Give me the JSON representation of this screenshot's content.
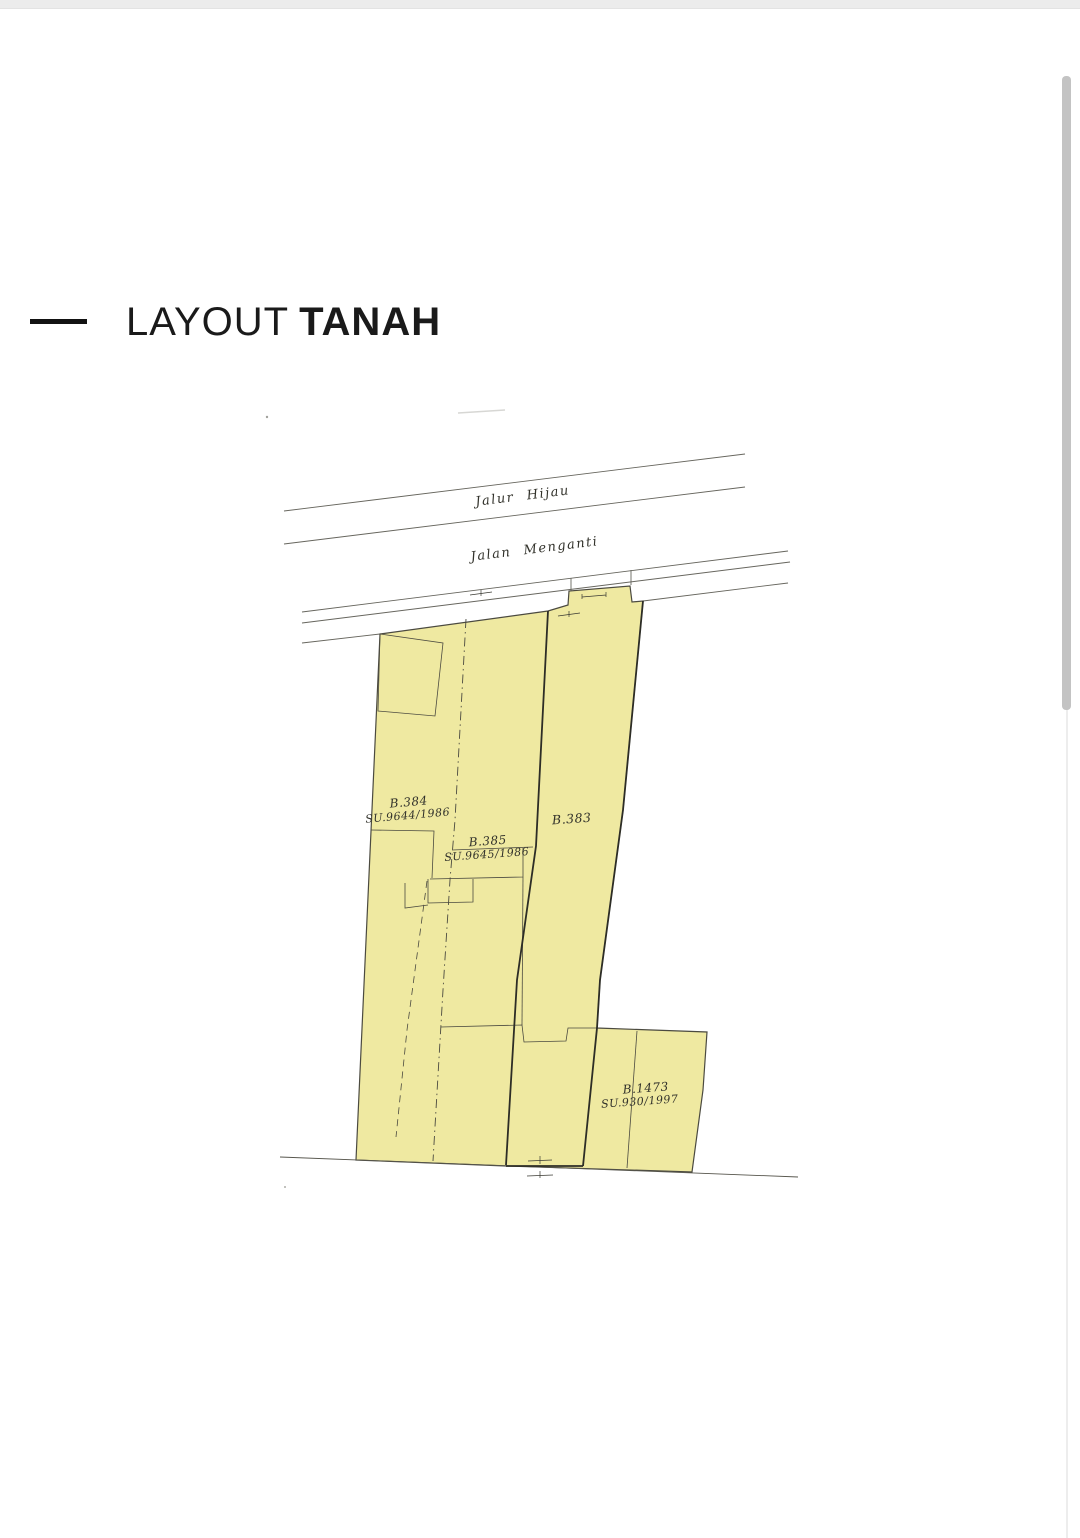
{
  "title": {
    "light": "LAYOUT",
    "bold": "TANAH"
  },
  "map": {
    "roads": {
      "jalur_hijau": "Jalur Hijau",
      "jalan_menganti": "Jalan Menganti"
    },
    "parcels": {
      "b384": {
        "id": "B.384",
        "su": "SU.9644/1986"
      },
      "b385": {
        "id": "B.385",
        "su": "SU.9645/1986"
      },
      "b383": {
        "id": "B.383"
      },
      "b1473": {
        "id": "B.1473",
        "su": "SU.930/1997"
      }
    },
    "colors": {
      "parcel_fill": "#efe9a1",
      "boundary": "#4b4a40",
      "boundary_dark": "#2d2d26"
    }
  }
}
